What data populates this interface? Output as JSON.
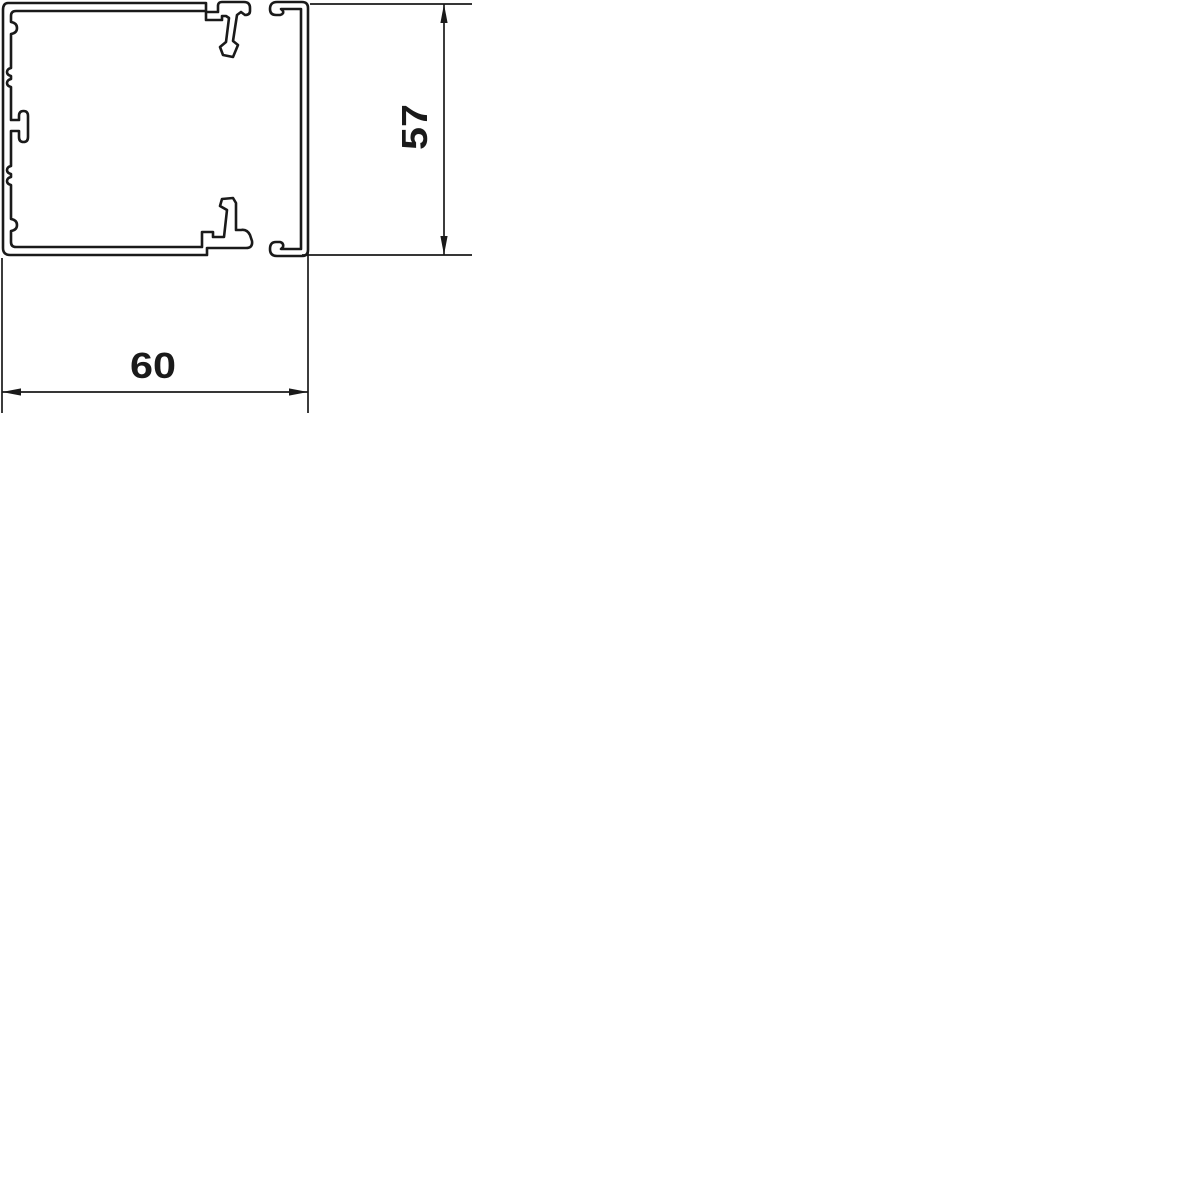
{
  "drawing": {
    "kind": "technical-cross-section",
    "parts": {
      "body": "trunking-body-profile",
      "lid": "trunking-lid-profile"
    }
  },
  "dimensions": {
    "width": {
      "value": "60",
      "orientation": "horizontal"
    },
    "height": {
      "value": "57",
      "orientation": "vertical"
    }
  },
  "colors": {
    "line": "#1a1a1a",
    "background": "#ffffff"
  }
}
